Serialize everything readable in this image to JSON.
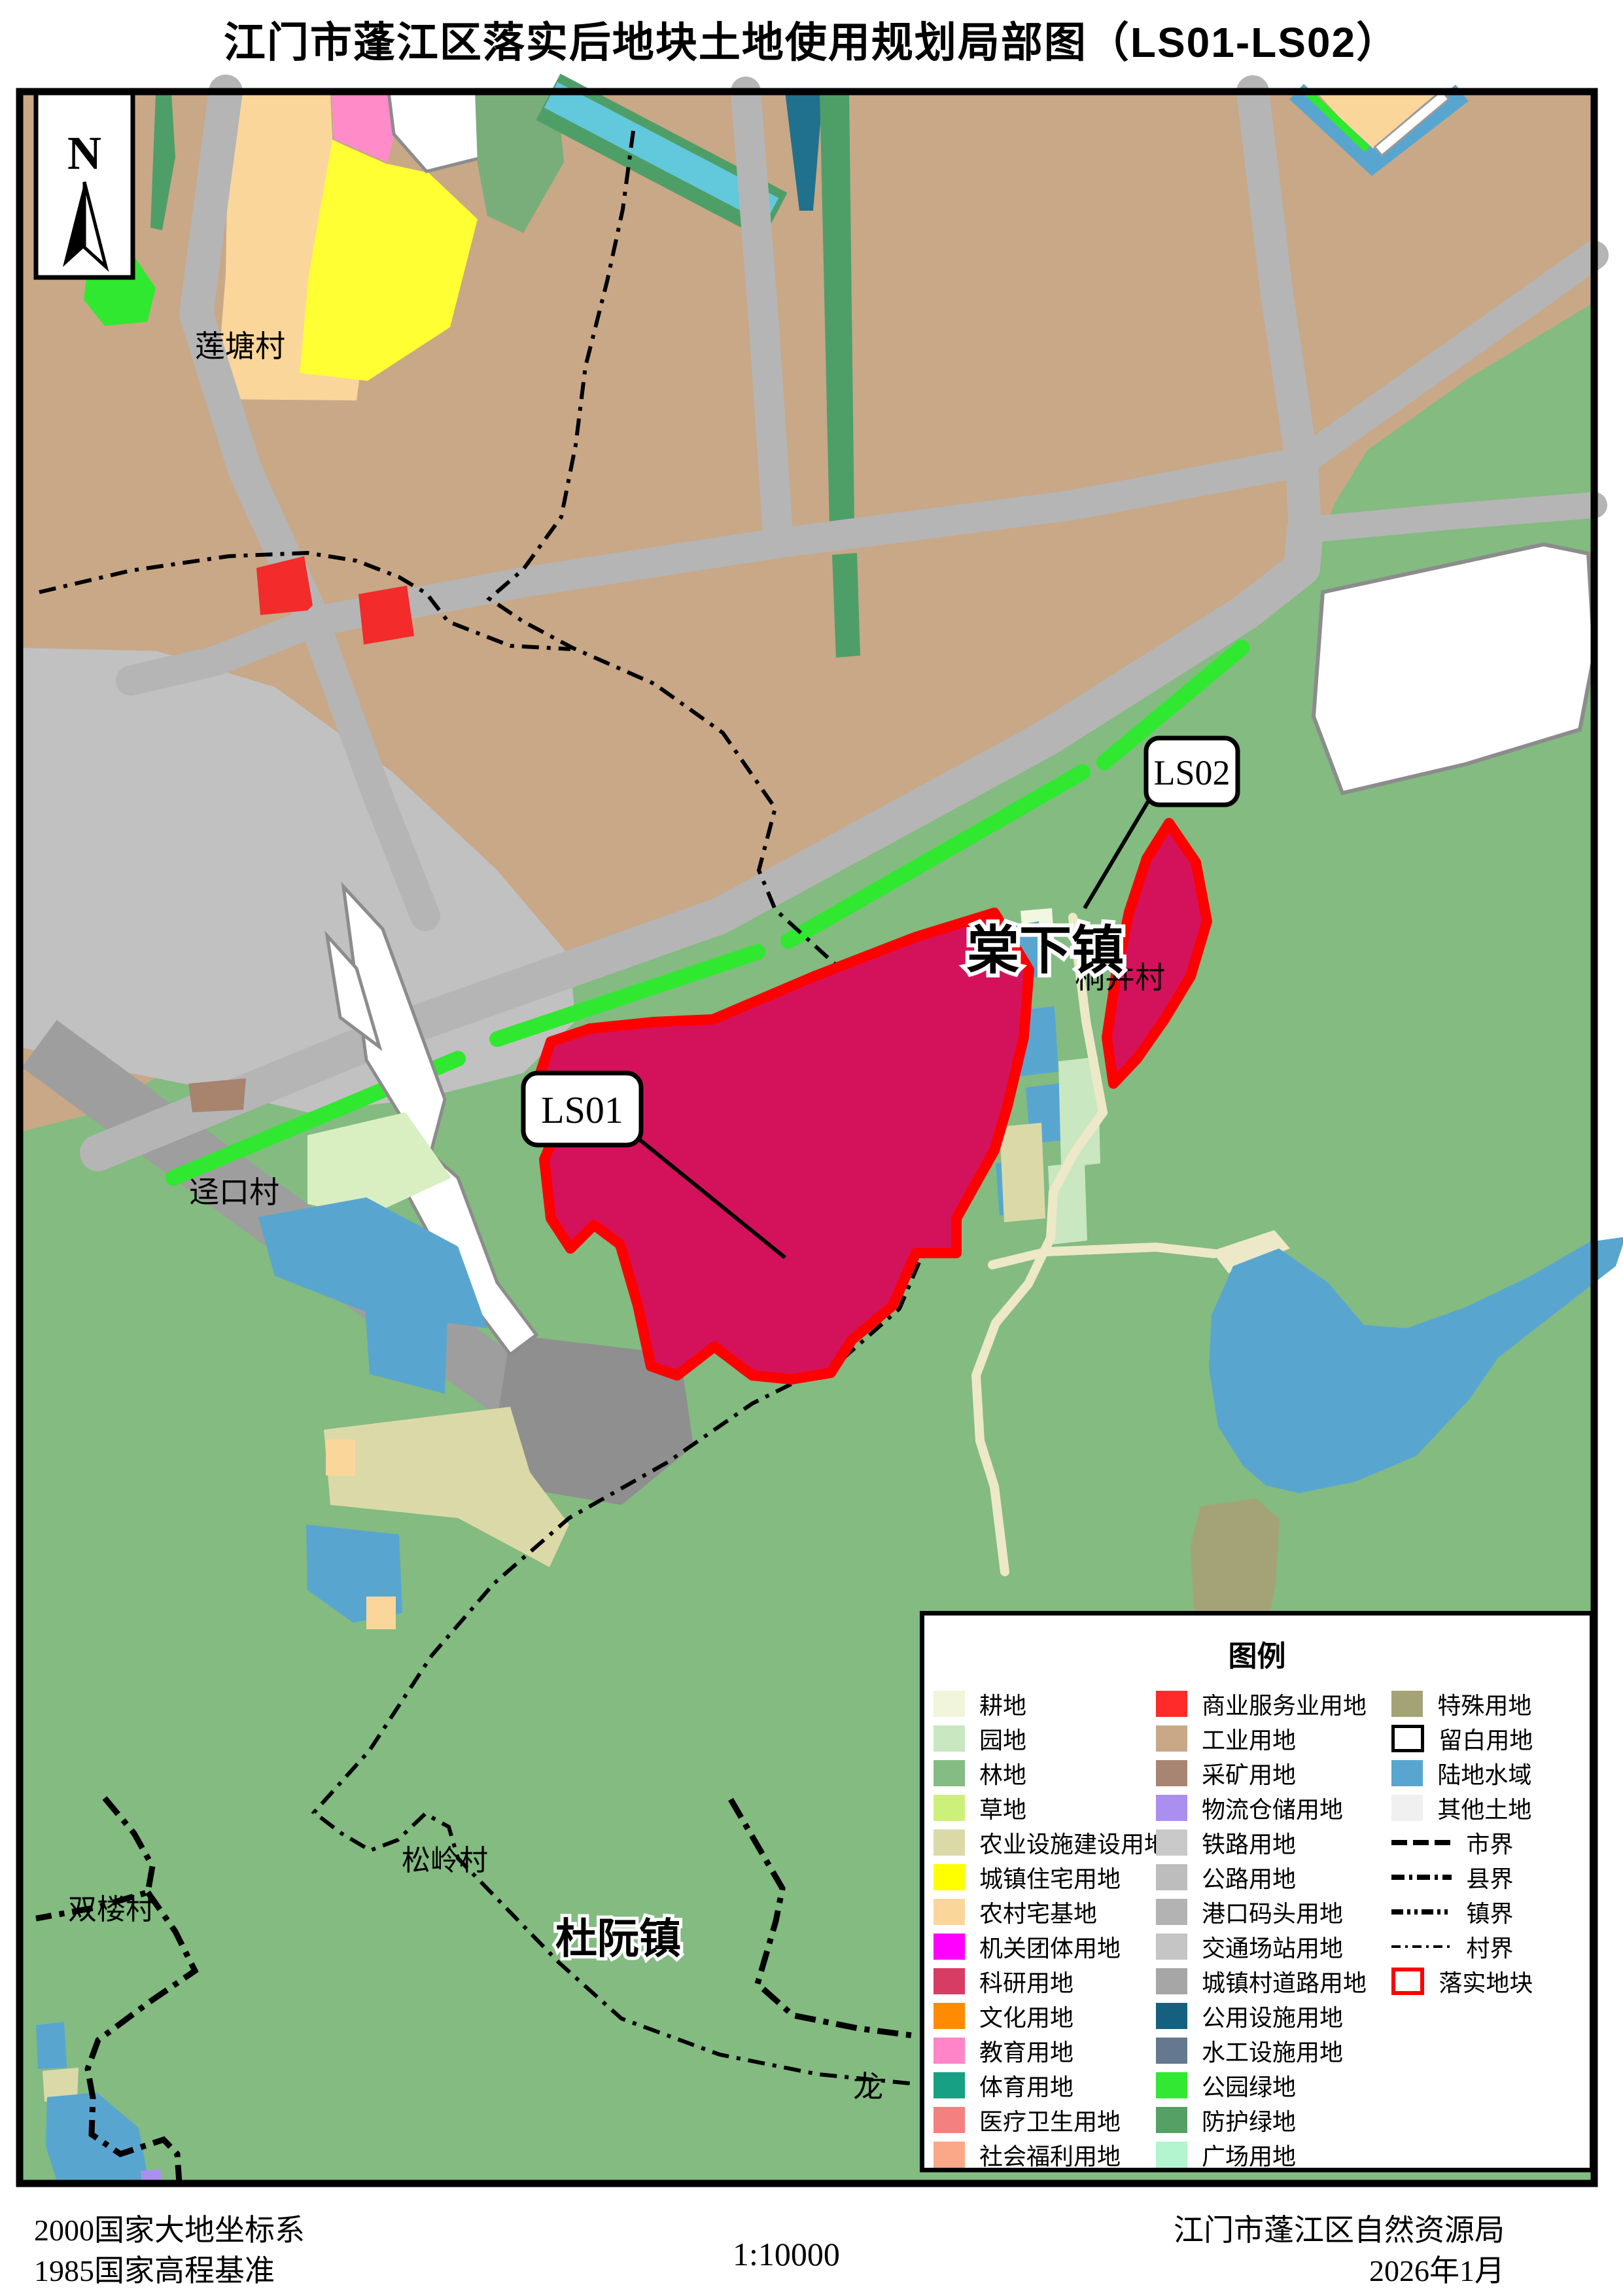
{
  "title": "江门市蓬江区落实后地块土地使用规划局部图（LS01-LS02）",
  "compass": {
    "north_label": "N"
  },
  "labels": {
    "liantang": "莲塘村",
    "jingkou": "迳口村",
    "tongjing": "桐井村",
    "songling": "松岭村",
    "shuanglou": "双楼村",
    "tangxia": "棠下镇",
    "duruan": "杜阮镇",
    "long_partial": "龙"
  },
  "callouts": {
    "ls01": "LS01",
    "ls02": "LS02"
  },
  "legend": {
    "title": "图例",
    "columns": [
      {
        "items": [
          {
            "label": "耕地",
            "swatch": {
              "kind": "fill",
              "color": "#F0F5DC"
            }
          },
          {
            "label": "园地",
            "swatch": {
              "kind": "fill",
              "color": "#C9E7C0"
            }
          },
          {
            "label": "林地",
            "swatch": {
              "kind": "fill",
              "color": "#84BC84"
            }
          },
          {
            "label": "草地",
            "swatch": {
              "kind": "fill",
              "color": "#CDF07A"
            }
          },
          {
            "label": "农业设施建设用地",
            "swatch": {
              "kind": "fill",
              "color": "#DCD9A9"
            }
          },
          {
            "label": "城镇住宅用地",
            "swatch": {
              "kind": "fill",
              "color": "#FFFF00"
            }
          },
          {
            "label": "农村宅基地",
            "swatch": {
              "kind": "fill",
              "color": "#FBD69B"
            }
          },
          {
            "label": "机关团体用地",
            "swatch": {
              "kind": "fill",
              "color": "#FF00FF"
            }
          },
          {
            "label": "科研用地",
            "swatch": {
              "kind": "fill",
              "color": "#D63C64"
            }
          },
          {
            "label": "文化用地",
            "swatch": {
              "kind": "fill",
              "color": "#FF8C00"
            }
          },
          {
            "label": "教育用地",
            "swatch": {
              "kind": "fill",
              "color": "#FF85C8"
            }
          },
          {
            "label": "体育用地",
            "swatch": {
              "kind": "fill",
              "color": "#17A083"
            }
          },
          {
            "label": "医疗卫生用地",
            "swatch": {
              "kind": "fill",
              "color": "#F58080"
            }
          },
          {
            "label": "社会福利用地",
            "swatch": {
              "kind": "fill",
              "color": "#FBA888"
            }
          }
        ]
      },
      {
        "items": [
          {
            "label": "商业服务业用地",
            "swatch": {
              "kind": "fill",
              "color": "#FF2A2A"
            }
          },
          {
            "label": "工业用地",
            "swatch": {
              "kind": "fill",
              "color": "#C8A887"
            }
          },
          {
            "label": "采矿用地",
            "swatch": {
              "kind": "fill",
              "color": "#A88572"
            }
          },
          {
            "label": "物流仓储用地",
            "swatch": {
              "kind": "fill",
              "color": "#AB8FF0"
            }
          },
          {
            "label": "铁路用地",
            "swatch": {
              "kind": "fill",
              "color": "#C9C9C9"
            }
          },
          {
            "label": "公路用地",
            "swatch": {
              "kind": "fill",
              "color": "#BDBDBD"
            }
          },
          {
            "label": "港口码头用地",
            "swatch": {
              "kind": "fill",
              "color": "#B3B3B3"
            }
          },
          {
            "label": "交通场站用地",
            "swatch": {
              "kind": "fill",
              "color": "#C5C5C5"
            }
          },
          {
            "label": "城镇村道路用地",
            "swatch": {
              "kind": "fill",
              "color": "#A6A6A6"
            }
          },
          {
            "label": "公用设施用地",
            "swatch": {
              "kind": "fill",
              "color": "#16607F"
            }
          },
          {
            "label": "水工设施用地",
            "swatch": {
              "kind": "fill",
              "color": "#64798F"
            }
          },
          {
            "label": "公园绿地",
            "swatch": {
              "kind": "fill",
              "color": "#33E833"
            }
          },
          {
            "label": "防护绿地",
            "swatch": {
              "kind": "fill",
              "color": "#55A065"
            }
          },
          {
            "label": "广场用地",
            "swatch": {
              "kind": "fill",
              "color": "#B2F5CE"
            }
          }
        ]
      },
      {
        "items": [
          {
            "label": "特殊用地",
            "swatch": {
              "kind": "fill",
              "color": "#A4A377"
            }
          },
          {
            "label": "留白用地",
            "swatch": {
              "kind": "blank"
            }
          },
          {
            "label": "陆地水域",
            "swatch": {
              "kind": "fill",
              "color": "#58A6D0"
            }
          },
          {
            "label": "其他土地",
            "swatch": {
              "kind": "fill",
              "color": "#F0F0F0"
            }
          },
          {
            "label": "市界",
            "swatch": {
              "kind": "line",
              "width": 8,
              "dash": "24 9"
            }
          },
          {
            "label": "县界",
            "swatch": {
              "kind": "line",
              "width": 8,
              "dash": "20 7 5 7"
            }
          },
          {
            "label": "镇界",
            "swatch": {
              "kind": "line",
              "width": 8,
              "dash": "18 6 5 6 5 6"
            }
          },
          {
            "label": "村界",
            "swatch": {
              "kind": "line",
              "width": 4,
              "dash": "14 7 4 7"
            }
          },
          {
            "label": "落实地块",
            "swatch": {
              "kind": "plot"
            }
          }
        ]
      }
    ]
  },
  "footer": {
    "coordinate_system": "2000国家大地坐标系",
    "height_datum": "1985国家高程基准",
    "scale": "1:10000",
    "agency": "江门市蓬江区自然资源局",
    "date": "2026年1月"
  },
  "colors": {
    "plot_outline": "#FF0000",
    "plot_fill": "#D4125C",
    "industrial_bg": "#C8A887",
    "forest_bg": "#83BB81",
    "road": "#B5B5B5",
    "water": "#58A6D0",
    "park_green": "#30E830"
  }
}
